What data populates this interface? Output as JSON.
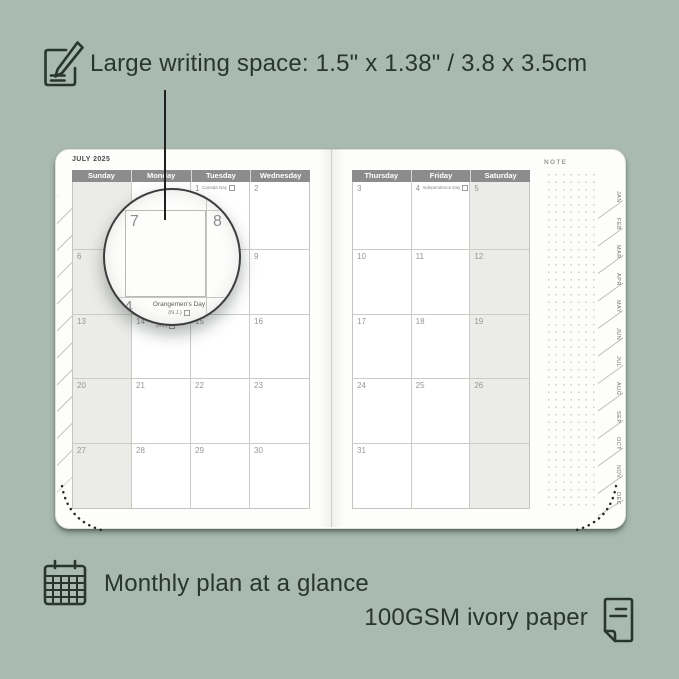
{
  "colors": {
    "background": "#a8bab1",
    "ink": "#28362f",
    "page": "#fdfdfb",
    "header_bg": "#8c8c8c",
    "header_text": "#ffffff",
    "shaded_column": "#ebebe8",
    "grid_line": "#cbcbc7",
    "date_text": "#96969a"
  },
  "annotations": {
    "top": {
      "icon": "pencil-note-icon",
      "text": "Large writing space: 1.5\" x 1.38\" / 3.8 x 3.5cm"
    },
    "bottom_left": {
      "icon": "calendar-grid-icon",
      "text": "Monthly plan at a glance"
    },
    "bottom_right": {
      "icon": "paper-icon",
      "text": "100GSM ivory paper"
    }
  },
  "planner": {
    "month_title": "JULY 2025",
    "note_label": "NOTE",
    "left_page": {
      "day_headers": [
        "Sunday",
        "Monday",
        "Tuesday",
        "Wednesday"
      ],
      "rows": [
        [
          {
            "day": ""
          },
          {
            "day": ""
          },
          {
            "day": "1",
            "event": "Canada Day"
          },
          {
            "day": "2"
          }
        ],
        [
          {
            "day": "6"
          },
          {
            "day": "7"
          },
          {
            "day": "8"
          },
          {
            "day": "9"
          }
        ],
        [
          {
            "day": "13"
          },
          {
            "day": "14",
            "event": "Orangemen's Day",
            "event2": "(N.J.)"
          },
          {
            "day": "15"
          },
          {
            "day": "16"
          }
        ],
        [
          {
            "day": "20"
          },
          {
            "day": "21"
          },
          {
            "day": "22"
          },
          {
            "day": "23"
          }
        ],
        [
          {
            "day": "27"
          },
          {
            "day": "28"
          },
          {
            "day": "29"
          },
          {
            "day": "30"
          }
        ]
      ]
    },
    "right_page": {
      "day_headers": [
        "Thursday",
        "Friday",
        "Saturday"
      ],
      "rows": [
        [
          {
            "day": "3"
          },
          {
            "day": "4",
            "event": "Independence Day"
          },
          {
            "day": "5"
          }
        ],
        [
          {
            "day": "10"
          },
          {
            "day": "11"
          },
          {
            "day": "12"
          }
        ],
        [
          {
            "day": "17"
          },
          {
            "day": "18"
          },
          {
            "day": "19"
          }
        ],
        [
          {
            "day": "24"
          },
          {
            "day": "25"
          },
          {
            "day": "26"
          }
        ],
        [
          {
            "day": "31"
          },
          {
            "day": ""
          },
          {
            "day": ""
          }
        ]
      ]
    },
    "month_tabs": [
      "JAN",
      "FEB",
      "MAR",
      "APR",
      "MAY",
      "JUN",
      "JUL",
      "AUG",
      "SEP",
      "OCT",
      "NOV",
      "DEC"
    ]
  },
  "magnifier": {
    "day_left": "7",
    "day_right": "8",
    "day_bottom": "14",
    "event_line1": "Orangemen's Day",
    "event_line2": "(N.J.)"
  }
}
